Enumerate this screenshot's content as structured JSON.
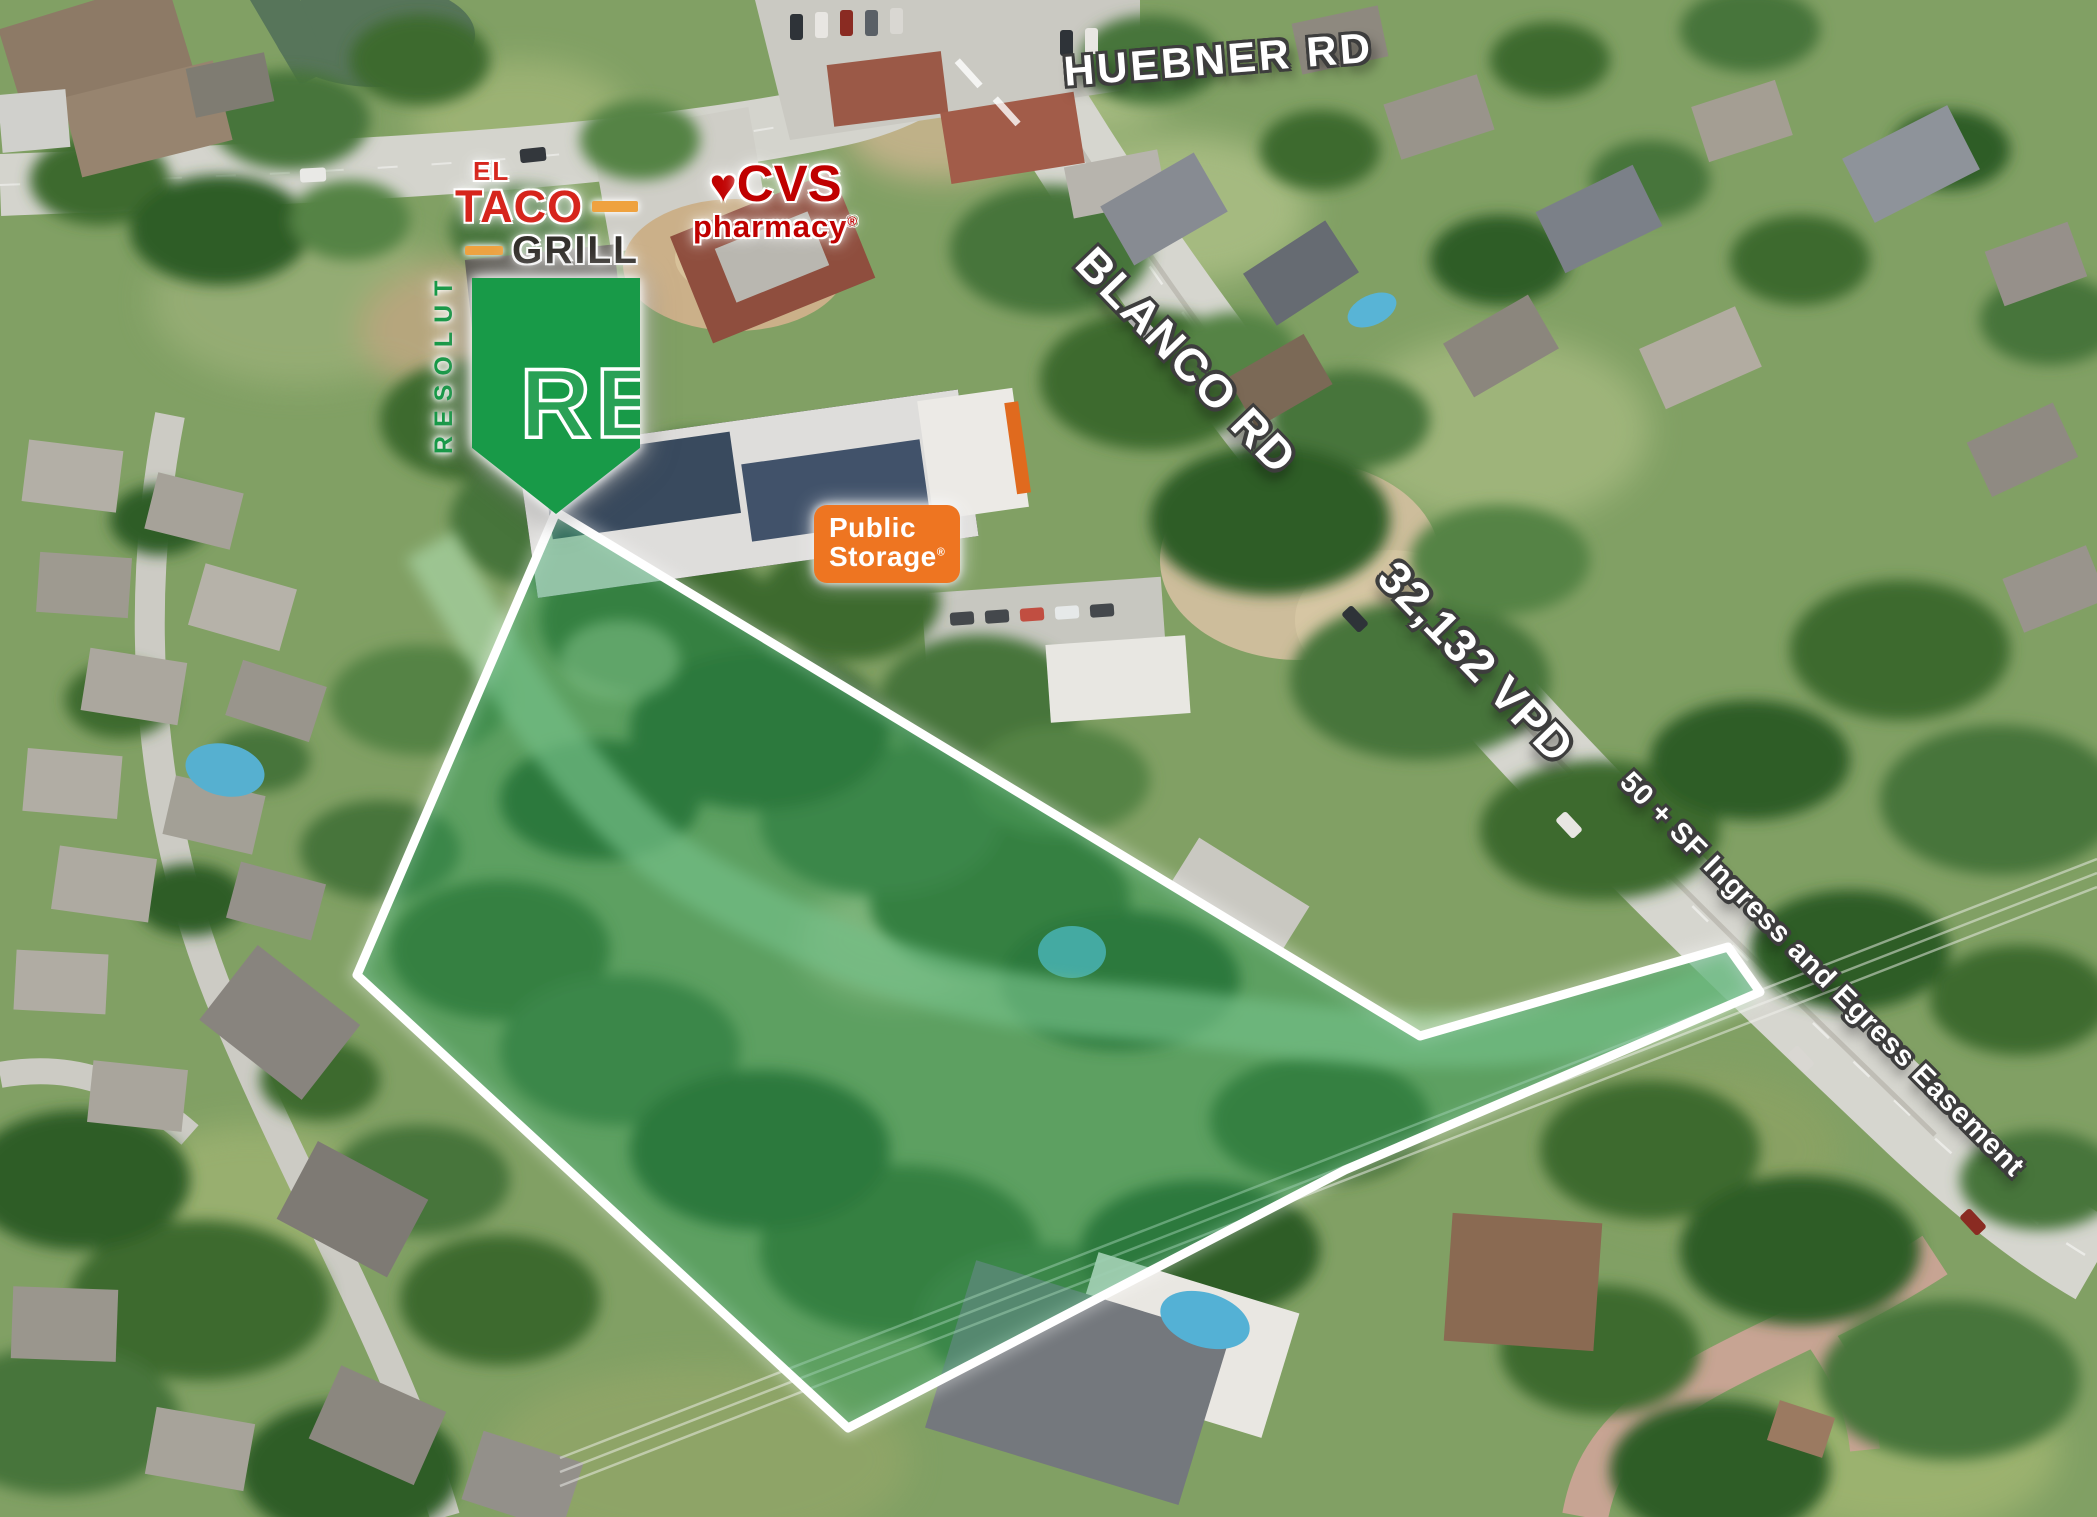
{
  "page": {
    "type": "aerial-site-map-flyer"
  },
  "road_labels": {
    "huebner": "HUEBNER RD",
    "blanco": "BLANCO RD",
    "traffic_count": "32,132 VPD",
    "easement": "50 + SF Ingress and Egress Easement",
    "text_color": "#FFFFFF",
    "outline_color": "#3D3D3D"
  },
  "parcel": {
    "overlay_color": "#2BA05C",
    "boundary_color": "#FFFFFF"
  },
  "logos": {
    "resolut": {
      "vertical_text": "RESOLUT",
      "monogram": "RE",
      "green": "#189A48"
    },
    "el_taco_grill": {
      "line1": "EL",
      "line2": "TACO",
      "line3": "GRILL",
      "red": "#D6251C",
      "orange": "#EFA23F",
      "charcoal": "#33302C"
    },
    "cvs": {
      "heart": "♥",
      "name": "CVS",
      "sub": "pharmacy",
      "registered": "®",
      "red": "#CC0000"
    },
    "public_storage": {
      "line1": "Public",
      "line2": "Storage",
      "registered": "®",
      "orange": "#EE7521"
    }
  }
}
